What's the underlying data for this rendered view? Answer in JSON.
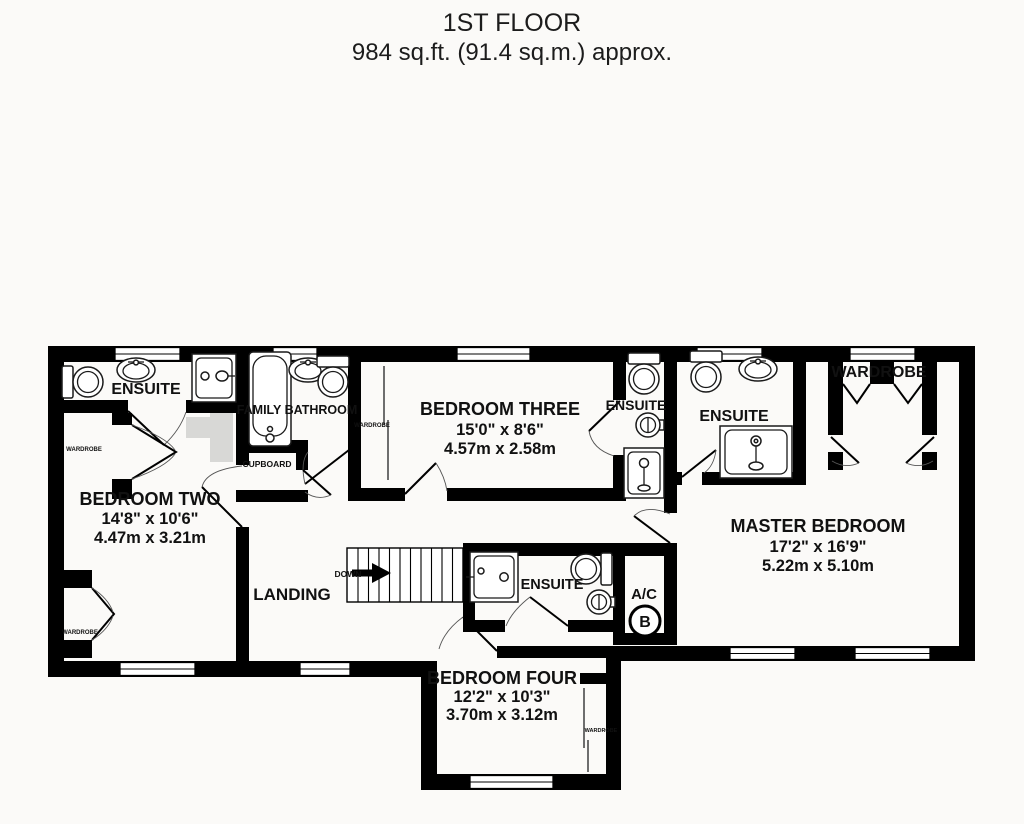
{
  "title": {
    "line1": "1ST FLOOR",
    "line2": "984 sq.ft. (91.4 sq.m.) approx."
  },
  "plan": {
    "colors": {
      "wall": "#000000",
      "background": "#fbfaf8",
      "shading": "#d8d8d6"
    },
    "stairs": {
      "label": "DOWN"
    },
    "rooms": {
      "ensuite_nw": {
        "name": "ENSUITE"
      },
      "family_bathroom": {
        "name": "FAMILY BATHROOM"
      },
      "cupboard": {
        "name": "CUPBOARD"
      },
      "bedroom_three": {
        "name": "BEDROOM THREE",
        "size_imperial": "15'0\"  x 8'6\"",
        "size_metric": "4.57m  x 2.58m"
      },
      "ensuite_bedroom_three": {
        "name": "ENSUITE"
      },
      "ensuite_master": {
        "name": "ENSUITE"
      },
      "wardrobe_master": {
        "name": "WARDROBE"
      },
      "master_bedroom": {
        "name": "MASTER BEDROOM",
        "size_imperial": "17'2\"  x 16'9\"",
        "size_metric": "5.22m  x 5.10m"
      },
      "bedroom_two": {
        "name": "BEDROOM TWO",
        "size_imperial": "14'8\"  x 10'6\"",
        "size_metric": "4.47m  x 3.21m"
      },
      "landing": {
        "name": "LANDING"
      },
      "ensuite_landing": {
        "name": "ENSUITE"
      },
      "ac_cupboard": {
        "name": "A/C",
        "boiler_symbol": "B"
      },
      "bedroom_four": {
        "name": "BEDROOM FOUR",
        "size_imperial": "12'2\"  x 10'3\"",
        "size_metric": "3.70m  x 3.12m"
      },
      "wardrobe_bedroom_two_upper": {
        "name": "WARDROBE"
      },
      "wardrobe_bedroom_two_lower": {
        "name": "WARDROBE"
      },
      "wardrobe_bedroom_three": {
        "name": "WARDROBE"
      },
      "wardrobe_bedroom_four": {
        "name": "WARDROBE"
      }
    }
  }
}
